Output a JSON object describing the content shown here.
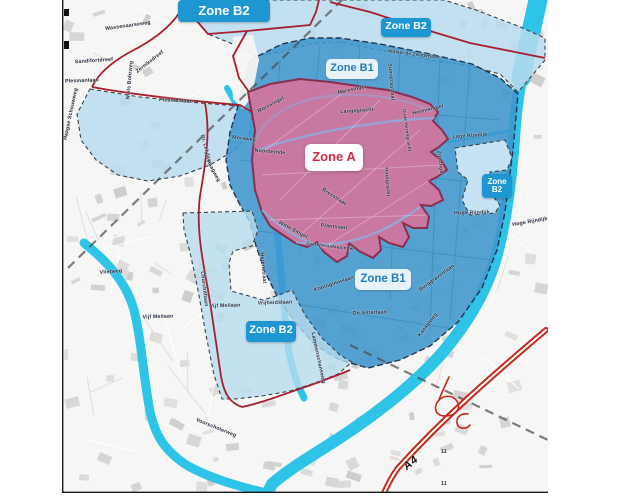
{
  "map": {
    "colors": {
      "zone_a": "#d4749c",
      "zone_a_border": "#8a2e4e",
      "zone_b1": "#3f96cd",
      "zone_b1_border": "#23364d",
      "zone_b2": "#b8dcef",
      "zone_b2_light": "#cfe8f5",
      "zone_b2_border": "#384048",
      "water": "#2ec4e8",
      "canal_city": "#92a9da",
      "boundary_red": "#a81e2e",
      "highway_red": "#c5281c",
      "railway_gray": "#4a4a4a",
      "label_blue_bg": "#1e96d2",
      "label_text_blue": "#1f7dc0",
      "label_text_red": "#cf2b45"
    },
    "zones": [
      {
        "id": "zone-b2-top",
        "lines": [
          "Zone B2"
        ],
        "x": 224,
        "y": 11,
        "w": 92,
        "h": 22,
        "style": "blue",
        "fs": 13
      },
      {
        "id": "zone-b2-topright",
        "lines": [
          "Zone B2"
        ],
        "x": 406,
        "y": 27,
        "w": 50,
        "h": 19,
        "style": "blue",
        "fs": 10.5
      },
      {
        "id": "zone-b1-north",
        "lines": [
          "Zone B1"
        ],
        "x": 352,
        "y": 69,
        "w": 52,
        "h": 20,
        "style": "light",
        "fs": 11
      },
      {
        "id": "zone-a",
        "lines": [
          "Zone A"
        ],
        "x": 334,
        "y": 157,
        "w": 58,
        "h": 27,
        "style": "white",
        "fs": 13
      },
      {
        "id": "zone-b2-east",
        "lines": [
          "Zone",
          "B2"
        ],
        "x": 497,
        "y": 186,
        "w": 30,
        "h": 24,
        "style": "blue",
        "fs": 8
      },
      {
        "id": "zone-b1-south",
        "lines": [
          "Zone B1"
        ],
        "x": 383,
        "y": 279,
        "w": 56,
        "h": 21,
        "style": "light",
        "fs": 11.5
      },
      {
        "id": "zone-b2-southwest",
        "lines": [
          "Zone B2"
        ],
        "x": 271,
        "y": 331,
        "w": 50,
        "h": 21,
        "style": "blue",
        "fs": 11
      }
    ],
    "street_labels": [
      {
        "t": "Wassenaarseweg",
        "x": 128,
        "y": 26,
        "r": -8
      },
      {
        "t": "Niels Bohrweg",
        "x": 130,
        "y": 80,
        "r": -85
      },
      {
        "t": "Zernikedreef",
        "x": 150,
        "y": 62,
        "r": -38
      },
      {
        "t": "Sandifortdreef",
        "x": 94,
        "y": 61,
        "r": -4
      },
      {
        "t": "Plesmanlaan",
        "x": 82,
        "y": 81,
        "r": -2
      },
      {
        "t": "Plesmanlaan",
        "x": 176,
        "y": 101,
        "r": 3
      },
      {
        "t": "Haagse Schouwweg",
        "x": 71,
        "y": 114,
        "r": -78
      },
      {
        "t": "Dr. Lelylaan",
        "x": 206,
        "y": 150,
        "r": 75
      },
      {
        "t": "Morsweg",
        "x": 244,
        "y": 139,
        "r": 8
      },
      {
        "t": "Haagweg",
        "x": 213,
        "y": 171,
        "r": 62
      },
      {
        "t": "Noordeinde",
        "x": 270,
        "y": 152,
        "r": 5
      },
      {
        "t": "Morssingel",
        "x": 271,
        "y": 105,
        "r": -28
      },
      {
        "t": "Maresingel",
        "x": 352,
        "y": 90,
        "r": -12
      },
      {
        "t": "Langegracht",
        "x": 357,
        "y": 111,
        "r": -4
      },
      {
        "t": "Oude Herengracht",
        "x": 407,
        "y": 130,
        "r": 82,
        "s": 4.6
      },
      {
        "t": "Herensingel",
        "x": 428,
        "y": 110,
        "r": -14
      },
      {
        "t": "Zijlsingel",
        "x": 440,
        "y": 163,
        "r": 84
      },
      {
        "t": "Hooigracht",
        "x": 387,
        "y": 182,
        "r": 86
      },
      {
        "t": "Breestraat",
        "x": 334,
        "y": 197,
        "r": 33
      },
      {
        "t": "Witte Singel",
        "x": 293,
        "y": 230,
        "r": 28
      },
      {
        "t": "Plantsoen",
        "x": 334,
        "y": 227,
        "r": 6
      },
      {
        "t": "Zoeterwoudsesingel",
        "x": 330,
        "y": 246,
        "r": 7,
        "s": 4.6
      },
      {
        "t": "Herenstraat",
        "x": 263,
        "y": 268,
        "r": 85
      },
      {
        "t": "Koninginnelaan",
        "x": 334,
        "y": 284,
        "r": -18
      },
      {
        "t": "Burggravenlaan",
        "x": 437,
        "y": 278,
        "r": -36
      },
      {
        "t": "Kanaalweg",
        "x": 428,
        "y": 325,
        "r": -52
      },
      {
        "t": "De Sitterlaan",
        "x": 370,
        "y": 313,
        "r": -2
      },
      {
        "t": "Lammenschansweg",
        "x": 318,
        "y": 358,
        "r": 78
      },
      {
        "t": "Vrijheidslaan",
        "x": 275,
        "y": 303,
        "r": -2
      },
      {
        "t": "Vijf Meilaan",
        "x": 225,
        "y": 306,
        "r": -2
      },
      {
        "t": "Vijf Meilaan",
        "x": 158,
        "y": 317,
        "r": -2
      },
      {
        "t": "Vlietweg",
        "x": 111,
        "y": 272,
        "r": -5
      },
      {
        "t": "Voorschoterweg",
        "x": 216,
        "y": 428,
        "r": 22
      },
      {
        "t": "Churchilllaan",
        "x": 204,
        "y": 289,
        "r": 83
      },
      {
        "t": "Lage Rijndijk",
        "x": 470,
        "y": 136,
        "r": -4
      },
      {
        "t": "Hoge Rijndijk",
        "x": 472,
        "y": 213,
        "r": -2
      },
      {
        "t": "Hoge Rijndijk",
        "x": 530,
        "y": 222,
        "r": -10
      },
      {
        "t": "Sumatrastraat",
        "x": 391,
        "y": 82,
        "r": 85
      },
      {
        "t": "Willem de Zwijgerlaan",
        "x": 414,
        "y": 54,
        "r": 7,
        "s": 4.6
      },
      {
        "t": "A4",
        "x": 411,
        "y": 463,
        "r": -40,
        "s": 11,
        "cls": "highway"
      },
      {
        "t": "11",
        "x": 444,
        "y": 452,
        "r": 0,
        "s": 5
      },
      {
        "t": "11",
        "x": 444,
        "y": 484,
        "r": 0,
        "s": 5
      }
    ]
  }
}
